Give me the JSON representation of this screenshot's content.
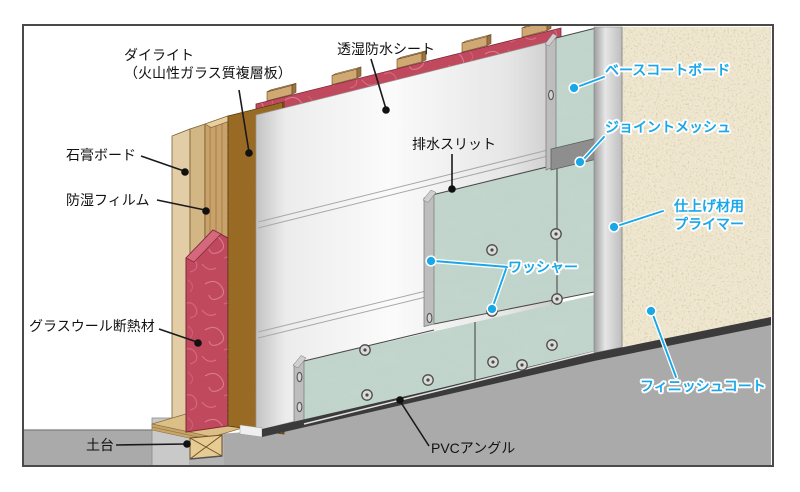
{
  "labels": {
    "dailite1": "ダイライト",
    "dailite2": "（火山性ガラス質複層板）",
    "sheet": "透湿防水シート",
    "gypsum": "石膏ボード",
    "film": "防湿フィルム",
    "glasswool": "グラスウール断熱材",
    "sill": "土台",
    "slit": "排水スリット",
    "pvc": "PVCアングル",
    "basecoat": "ベースコートボード",
    "jointmesh": "ジョイントメッシュ",
    "primer1": "仕上げ材用",
    "primer2": "プライマー",
    "washer": "ワッシャー",
    "finish": "フィニッシュコート"
  },
  "colors": {
    "accent_cyan": "#19a7e8",
    "label_black": "#111111",
    "frame_border": "#4a4a4a",
    "glasswool_red": "#c1495e",
    "dailite_brown": "#9c6a22",
    "stud_wood": "#c9a26b",
    "gypsum_tan": "#e3cda6",
    "gypsum_tan2": "#d2b684",
    "basecoat_teal": "#c2d6cd",
    "finish_beige": "#eee6cf",
    "primer_gray": "#c4c4c4",
    "concrete_gray": "#aaaaaa",
    "pvc_dark": "#3b3b3b",
    "sheet_white": "#f6f6f6"
  }
}
